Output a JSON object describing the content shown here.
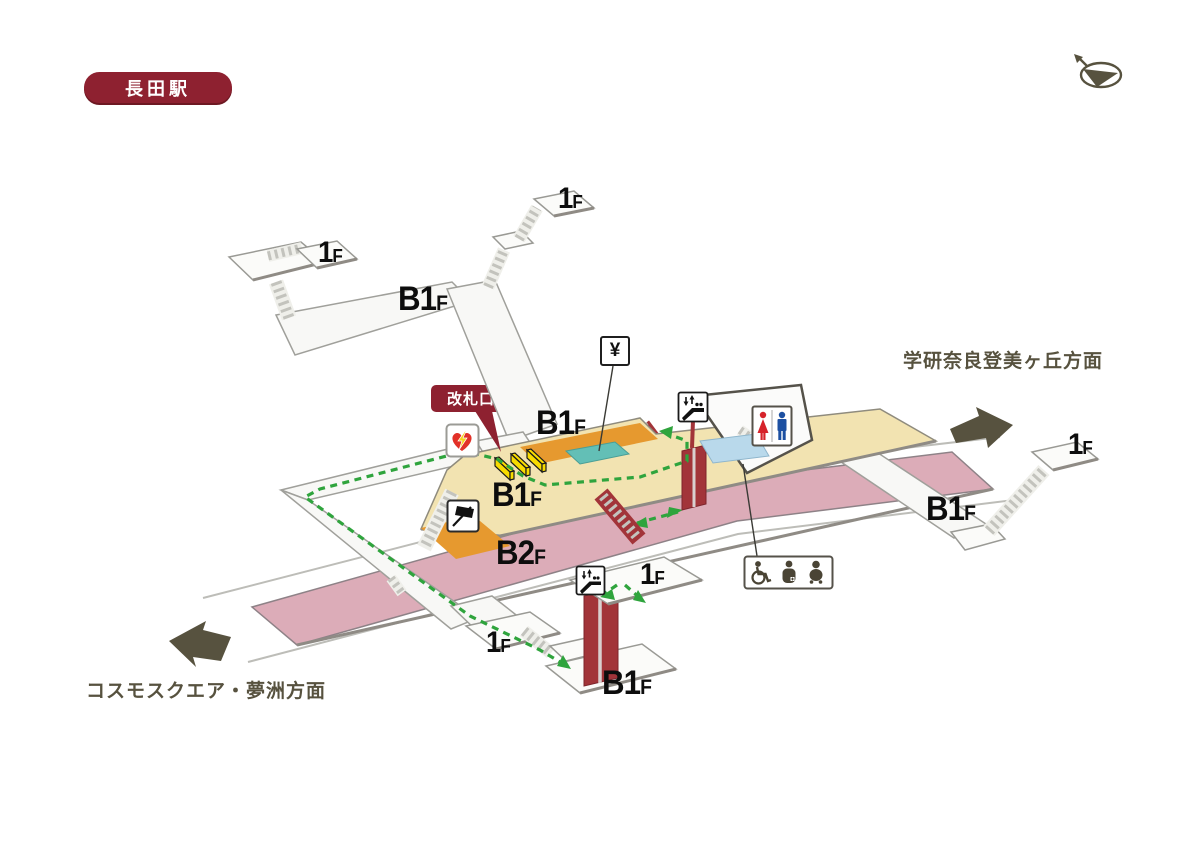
{
  "station": {
    "name": "長田駅"
  },
  "badges": {
    "ticket_gate": "改札口"
  },
  "directions": {
    "right": "学研奈良登美ヶ丘方面",
    "left": "コスモスクエア・夢洲方面"
  },
  "signs": {
    "yen": "¥"
  },
  "platform_numbers": {
    "no1": "1",
    "no2": "2"
  },
  "floor_labels": {
    "tl1f": {
      "main": "1",
      "sub": "F"
    },
    "tc1f": {
      "main": "1",
      "sub": "F"
    },
    "topb1f": {
      "main": "B1",
      "sub": "F"
    },
    "midb1f": {
      "main": "B1",
      "sub": "F"
    },
    "concb1f": {
      "main": "B1",
      "sub": "F"
    },
    "b2f": {
      "main": "B2",
      "sub": "F"
    },
    "right1f": {
      "main": "1",
      "sub": "F"
    },
    "rightb1f": {
      "main": "B1",
      "sub": "F"
    },
    "bot1f_upper": {
      "main": "1",
      "sub": "F"
    },
    "bot1f_lower": {
      "main": "1",
      "sub": "F"
    },
    "botb1f": {
      "main": "B1",
      "sub": "F"
    }
  },
  "icons": {
    "aed": "aed-heart-lightning",
    "station_office": "station-office-flag",
    "ticket_machines": "ticket-machine-area",
    "escalator": "escalator-sign",
    "toilet": "toilet-sign",
    "accessible_toilet": "wheelchair-ostomate-baby-sign",
    "elevator_pad": "elevator-area",
    "compass": "north-compass"
  },
  "colors": {
    "badge_red": "#8E2130",
    "concourse_tan": "#F2E3B1",
    "concourse_orange": "#E6992F",
    "machines_teal": "#63BFB6",
    "platform_pink": "#DCACB8",
    "route_green": "#2FA43D",
    "escalator_red": "#A23439",
    "gate_yellow": "#F8DB00",
    "elevator_blue": "#B9D9EB",
    "arrow_olive": "#57523F"
  }
}
